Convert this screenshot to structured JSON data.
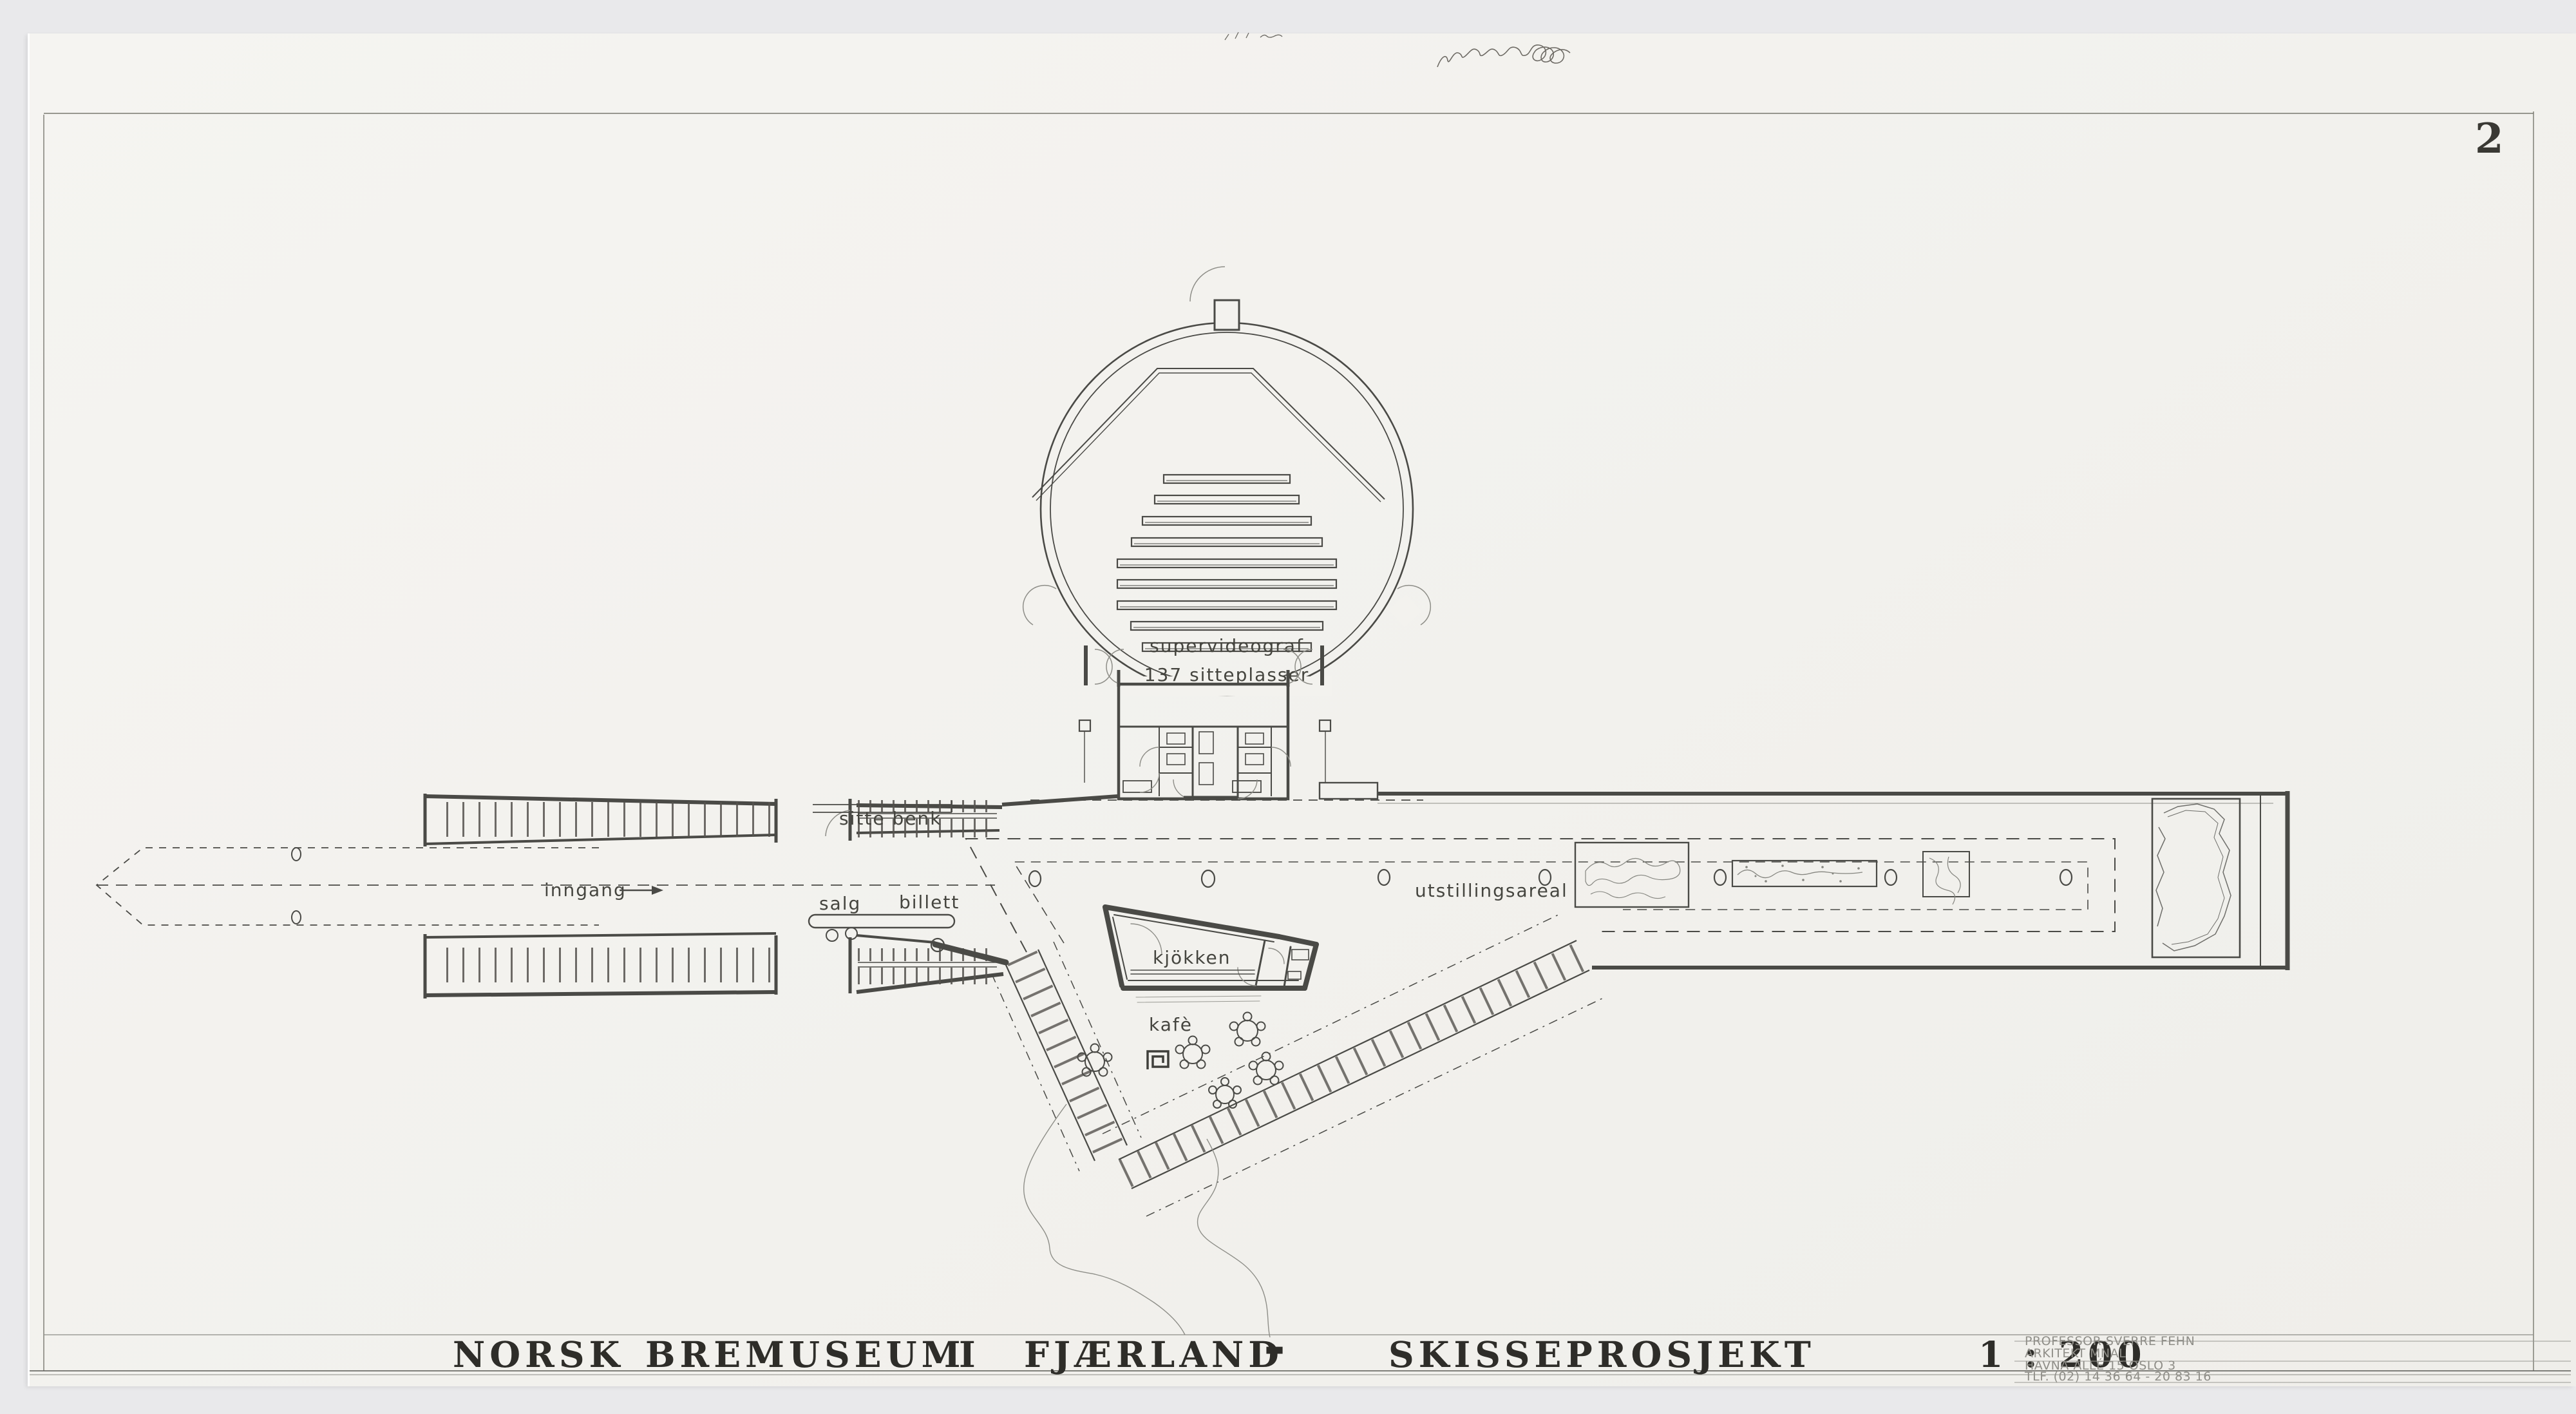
{
  "sheet": {
    "number": "2"
  },
  "title": {
    "parts": [
      "NORSK",
      "BREMUSEUM",
      "I",
      "FJÆRLAND",
      "-",
      "SKISSEPROSJEKT",
      "1 : 200"
    ]
  },
  "plan_labels": {
    "auditorium_name": "supervideograf",
    "auditorium_seats": "137 sitteplasser",
    "bench": "sitte benk",
    "entrance": "inngang",
    "sales": "salg",
    "tickets": "billett",
    "kitchen": "kjökken",
    "cafe": "kafè",
    "exhibition_area": "utstillingsareal"
  },
  "stamp": {
    "lines": [
      "PROFESSOR SVERRE FEHN",
      "ARKITEKT MNAL",
      "HAVNA ALLÉ 15 OSLO 3",
      "TLF. (02) 14 36 64 - 20 83 16"
    ]
  },
  "colors": {
    "paper": "#f3f2ee",
    "background": "#e9e9eb",
    "ink": "#4a4a46",
    "light_ink": "#8e8e88",
    "stamp_ink": "#8f8e88",
    "title_ink": "#2e2d29"
  }
}
